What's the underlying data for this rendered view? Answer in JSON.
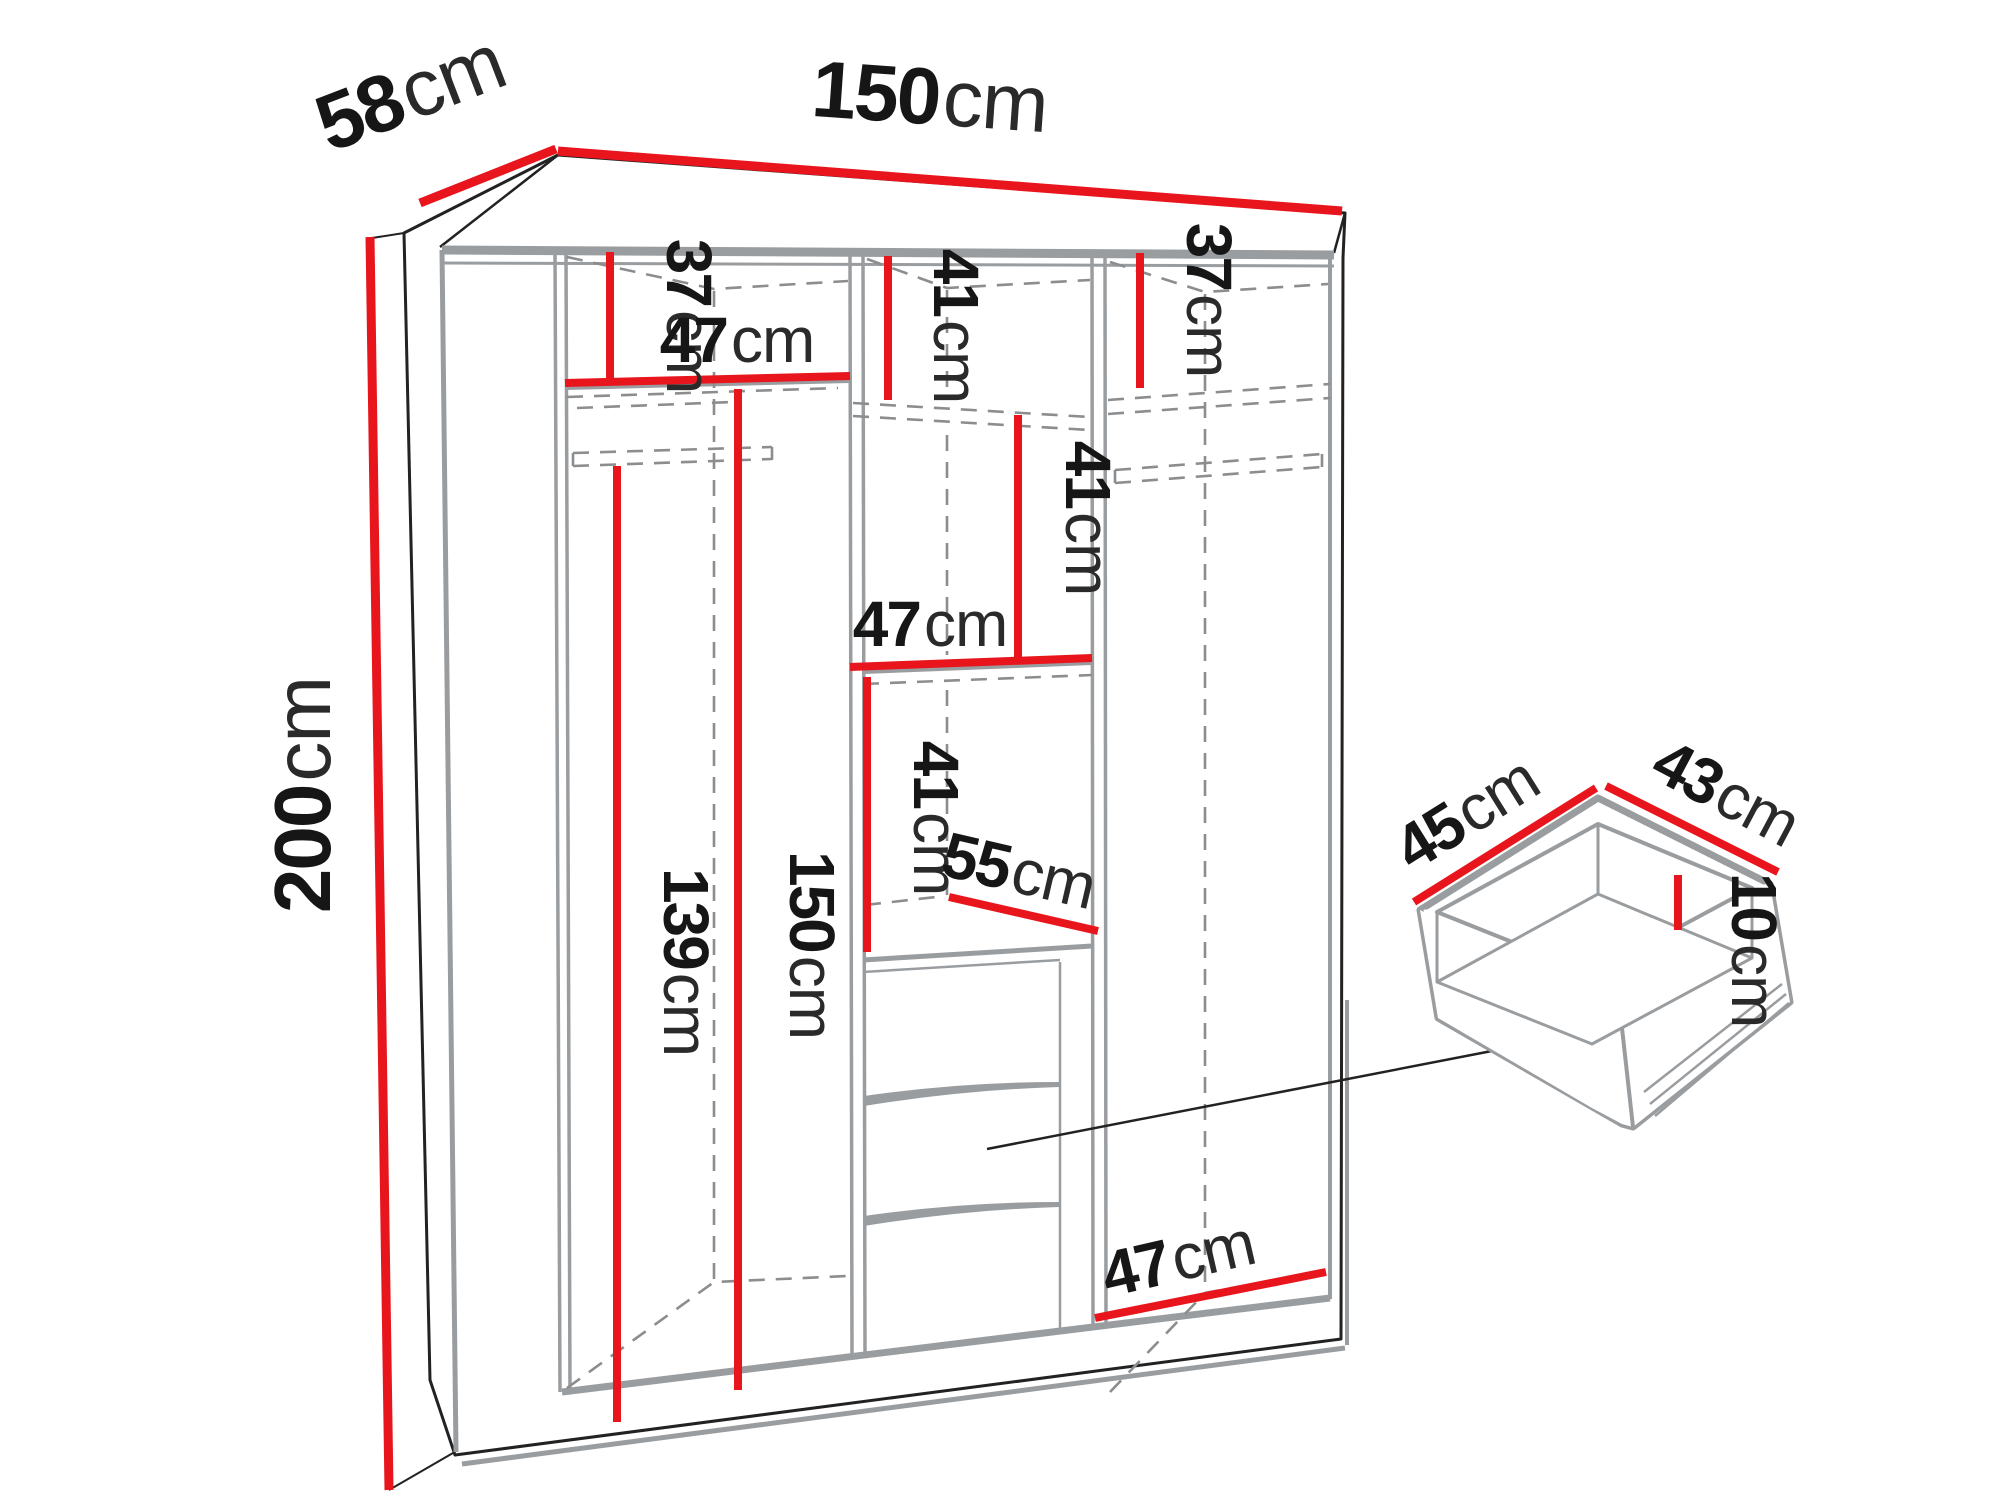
{
  "diagram": {
    "type": "furniture-dimension-diagram",
    "subject": "three-section wardrobe with drawer detail",
    "dimension_color": "#e8151d",
    "structure_color": "#9a9da0",
    "outline_color": "#222222",
    "wardrobe": {
      "width": {
        "value": "150",
        "unit": "cm"
      },
      "depth": {
        "value": "58",
        "unit": "cm"
      },
      "height": {
        "value": "200",
        "unit": "cm"
      },
      "left_top_section_height": {
        "value": "37",
        "unit": "cm"
      },
      "left_shelf_width": {
        "value": "47",
        "unit": "cm"
      },
      "left_hanging_space_height": {
        "value": "139",
        "unit": "cm"
      },
      "left_interior_height": {
        "value": "150",
        "unit": "cm"
      },
      "middle_top_section_height": {
        "value": "41",
        "unit": "cm"
      },
      "middle_second_section_height": {
        "value": "41",
        "unit": "cm"
      },
      "middle_shelf_width": {
        "value": "47",
        "unit": "cm"
      },
      "middle_third_section_height": {
        "value": "41",
        "unit": "cm"
      },
      "middle_section_depth": {
        "value": "55",
        "unit": "cm"
      },
      "right_top_section_height": {
        "value": "37",
        "unit": "cm"
      },
      "right_floor_width": {
        "value": "47",
        "unit": "cm"
      }
    },
    "drawer_detail": {
      "width": {
        "value": "45",
        "unit": "cm"
      },
      "depth": {
        "value": "43",
        "unit": "cm"
      },
      "height": {
        "value": "10",
        "unit": "cm"
      }
    }
  }
}
